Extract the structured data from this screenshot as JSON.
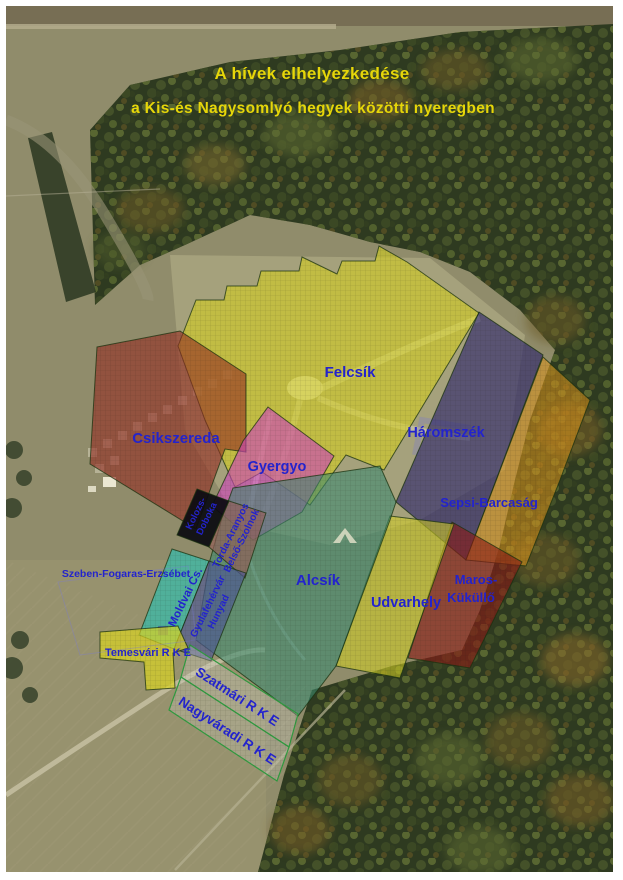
{
  "title": {
    "line1": "A hívek elhelyezkedése",
    "line2": "a Kis-és Nagysomlyó hegyek közötti nyeregben",
    "color": "#e6d609"
  },
  "label_color": "#2323cd",
  "regions": {
    "felcsik": {
      "label": "Felcsík",
      "fill": "#d6d11c"
    },
    "csikszereda": {
      "label": "Csikszereda",
      "fill": "#942c22"
    },
    "gyergyo": {
      "label": "Gyergyo",
      "fill": "#cd44bc"
    },
    "haromszek": {
      "label": "Háromszék",
      "fill": "#2a246c"
    },
    "sepsi_barcasag": {
      "label": "Sepsi-Barcaság",
      "fill": "#de961c"
    },
    "maros_kukullo": {
      "line1": "Maros-",
      "line2": "Küküllő",
      "fill": "#8a1c16"
    },
    "udvarhely": {
      "label": "Udvarhely",
      "fill": "#d3ce26"
    },
    "alcsik": {
      "label": "Alcsík",
      "fill": "#3a8a70"
    },
    "kolozs_doboka": {
      "line1": "Kolozs-",
      "line2": "Doboka",
      "fill": "#0a0a10"
    },
    "torda_belso": {
      "line1": "Torda-Aranyos",
      "line2": "Belső-Szolnok",
      "fill": "#945e58"
    },
    "moldvai": {
      "label": "Moldvai Cs.",
      "fill": "#38baaa"
    },
    "gyulafehervar_hunyad": {
      "line1": "Gyulafehérvár",
      "line2": "Hunyad",
      "fill": "#4e5894"
    },
    "szeben": {
      "label": "Szeben-Fogaras-Erzsébet"
    },
    "temesvari": {
      "label": "Temesvári R K E",
      "fill": "#dad422"
    },
    "szatmari": {
      "label": "Szatmári R K E",
      "fill": "#d8d8d2"
    },
    "nagyvaradi": {
      "label": "Nagyváradi R K E",
      "fill": "#d2d4cd"
    }
  }
}
